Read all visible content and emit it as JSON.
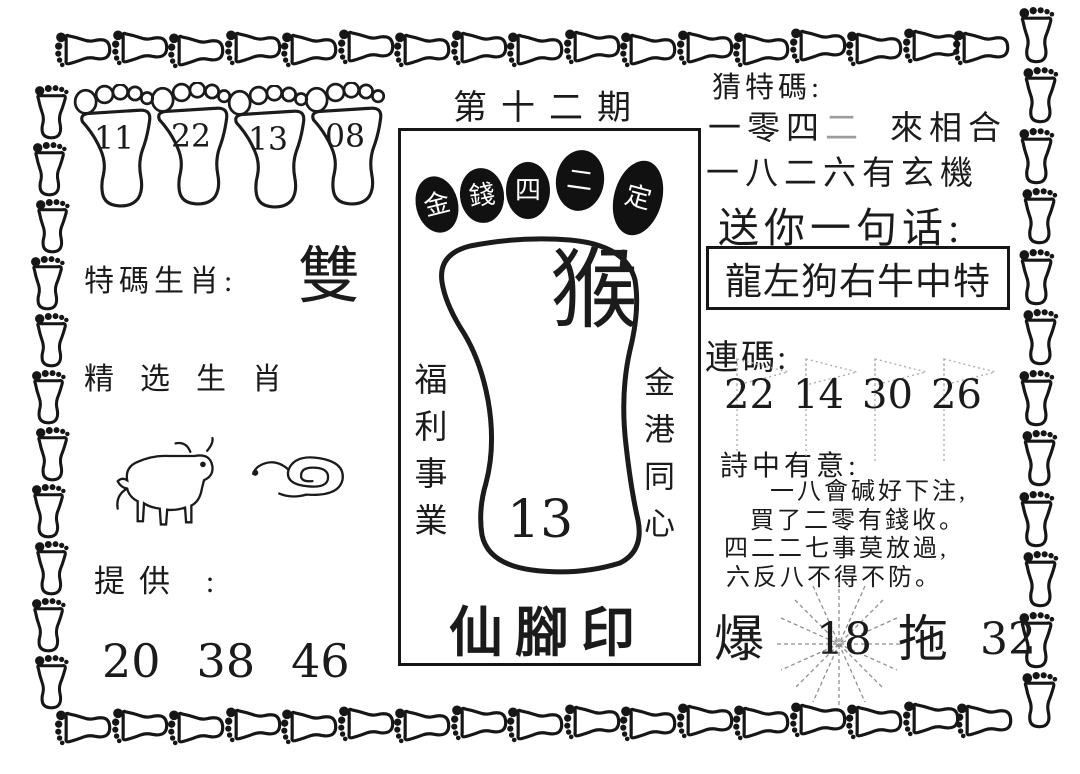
{
  "issue_title": "第十二期",
  "top_feet": {
    "numbers": [
      "11",
      "22",
      "13",
      "08"
    ]
  },
  "left_panel": {
    "special_zodiac_label": "特碼生肖:",
    "special_zodiac_value": "雙",
    "selected_zodiac_label": "精选生肖",
    "animals": [
      "ox",
      "snake"
    ],
    "provide_label": "提供 :",
    "provide_numbers": [
      "20",
      "38",
      "46"
    ]
  },
  "center_stamp": {
    "toe_chars": [
      "金",
      "錢",
      "四",
      "二",
      "定"
    ],
    "zodiac_char": "猴",
    "number": "13",
    "left_vertical": "福利事業",
    "right_vertical": "金港同心",
    "bottom_title": "仙腳印"
  },
  "right_panel": {
    "guess_label": "猜特碼:",
    "guess_line1": {
      "a": "一零四",
      "b": "二",
      "c": "來相合"
    },
    "guess_line2": "一八二六有玄機",
    "message_label": "送你一句话:",
    "message_value": "龍左狗右牛中特",
    "serial_label": "連碼:",
    "serial_numbers": [
      "22",
      "14",
      "30",
      "26"
    ],
    "poem_label": "詩中有意:",
    "poem_lines": [
      "一八會碱好下注,",
      "買了二零有錢收。",
      "四二二七事莫放過,",
      "六反八不得不防。"
    ],
    "burst_label": "爆",
    "burst_number": "18",
    "drag_label": "拖",
    "drag_number": "32"
  },
  "colors": {
    "ink": "#161616",
    "paper": "#ffffff",
    "faded": "#9d9d9d"
  }
}
